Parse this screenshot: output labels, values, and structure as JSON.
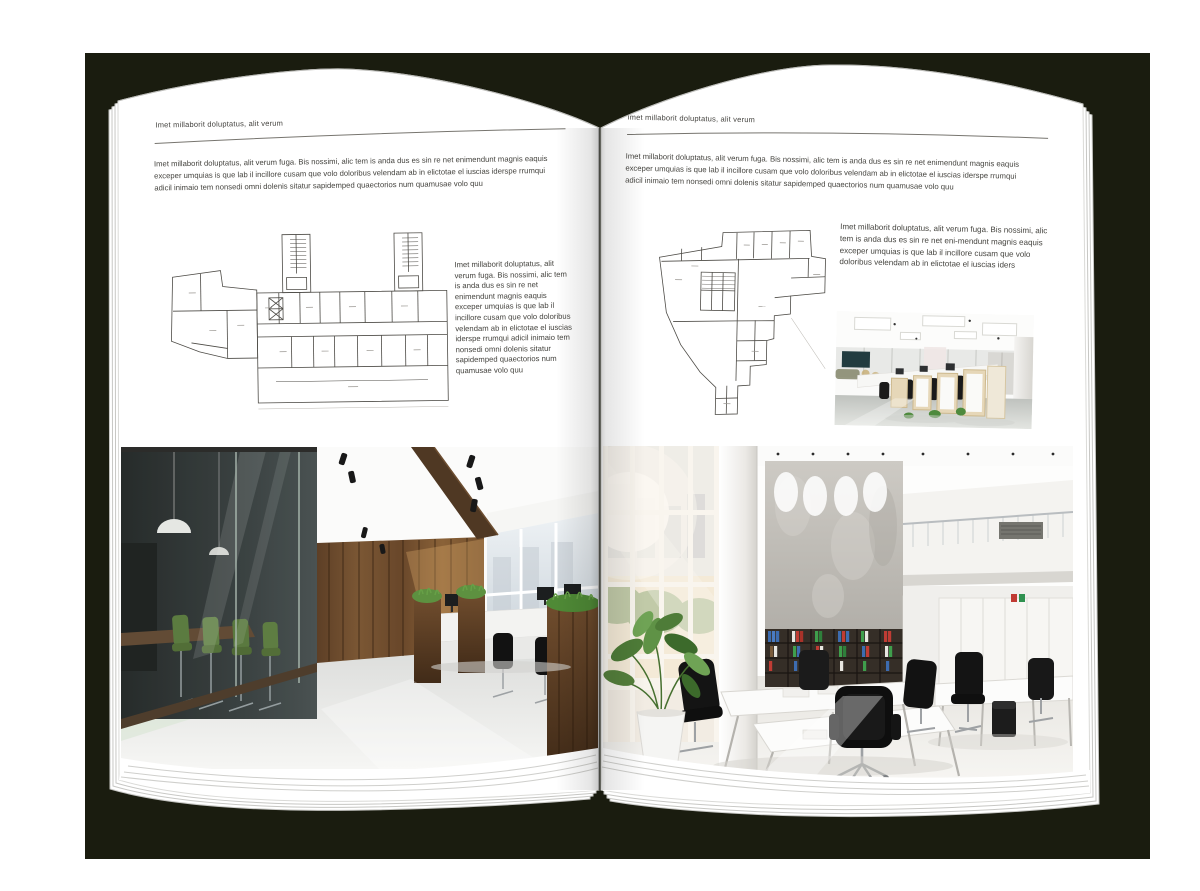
{
  "colors": {
    "backdrop": "#1a1c0f",
    "page": "#ffffff",
    "rule": "#6e6e6e",
    "text": "#45443f"
  },
  "left_page": {
    "header": "Imet millaborit doluptatus, alit verum",
    "intro": "Imet millaborit doluptatus, alit verum fuga. Bis nossimi, alic tem is anda dus es sin re net enimendunt magnis eaquis exceper umquias is que lab il incillore cusam que volo doloribus velendam ab in elictotae el iuscias iderspe rrumqui adicil inimaio tem nonsedi omni dolenis sitatur sapidemped quaectorios num quamusae volo quu",
    "column_text": "Imet millaborit doluptatus, alit verum fuga. Bis nossimi, alic tem is anda dus es sin re net enimendunt magnis eaquis exceper umquias is que lab il incillore cusam que volo doloribus velendam ab in elictotae el iuscias iderspe rrumqui adicil inimaio tem nonsedi omni dolenis sitatur sapidemped quaectorios num quamusae volo quu"
  },
  "right_page": {
    "header": "Imet millaborit doluptatus, alit verum",
    "intro": "Imet millaborit doluptatus, alit verum fuga. Bis nossimi, alic tem is anda dus es sin re net enimendunt magnis eaquis exceper umquias is que lab il incillore cusam que volo doloribus velendam ab in elictotae el iuscias iderspe rrumqui adicil inimaio tem nonsedi omni dolenis sitatur sapidemped quaectorios num quamusae volo quu",
    "column_text": "Imet millaborit doluptatus, alit verum fuga. Bis nossimi, alic tem is anda dus es sin re net eni-mendunt magnis eaquis exceper umquias is que lab il incillore cusam que volo doloribus velendam ab in elictotae el iuscias iders"
  }
}
